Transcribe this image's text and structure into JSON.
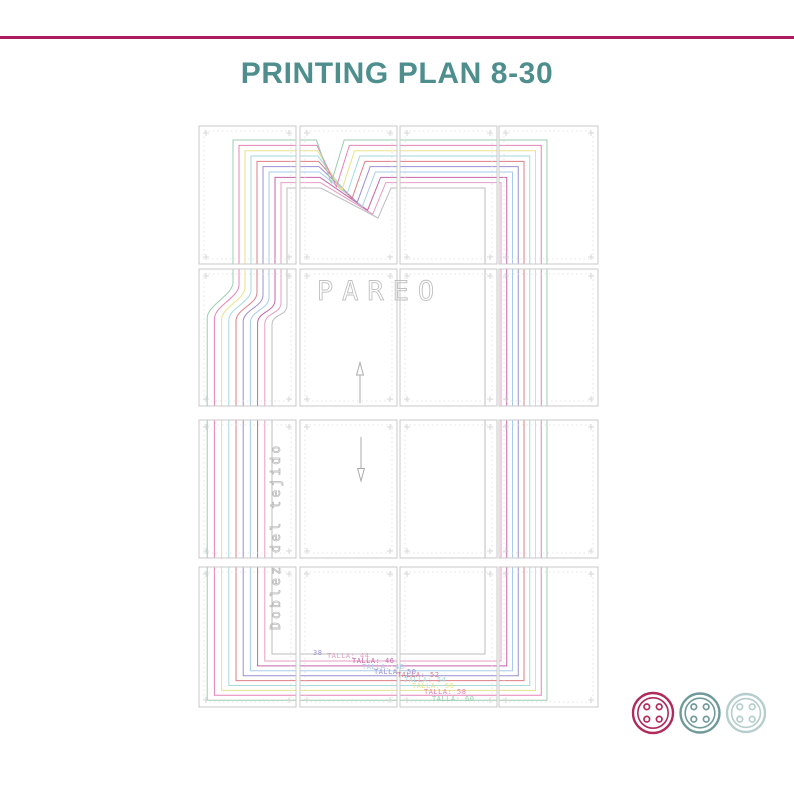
{
  "page": {
    "width": 794,
    "height": 794,
    "background": "#ffffff"
  },
  "header": {
    "title": "PRINTING PLAN 8-30",
    "title_color": "#4e8f8e",
    "rule_color": "#ad1a60"
  },
  "plan": {
    "border_color": "#c9c9c9",
    "margin_dash_color": "#dedede",
    "mark_color": "#cfcfcf",
    "cols": [
      {
        "x": 199,
        "w": 97
      },
      {
        "x": 300,
        "w": 97
      },
      {
        "x": 400,
        "w": 97
      },
      {
        "x": 499,
        "w": 99
      }
    ],
    "rows": [
      {
        "y": 126,
        "h": 138
      },
      {
        "y": 269,
        "h": 137
      },
      {
        "y": 420,
        "h": 138
      },
      {
        "y": 567,
        "h": 140
      }
    ],
    "pareo_label": {
      "text": "PAREO",
      "x": 380,
      "y": 300,
      "size": 27,
      "spacing": 9,
      "color": "#c0c0c0"
    },
    "fold_label": {
      "text": "Doblez del tejido",
      "x": 280,
      "y": 630,
      "size": 13,
      "spacing": 3.2,
      "color": "#b6b6b6"
    },
    "arrow_color": "#ababab",
    "arrows": [
      {
        "dir": "up",
        "x": 360,
        "tail_y": 403,
        "head_base_y": 375,
        "tip_y": 362.5,
        "half_w": 3.4
      },
      {
        "dir": "down",
        "x": 361,
        "tail_y": 437,
        "head_base_y": 468.5,
        "tip_y": 481,
        "half_w": 3.4
      }
    ],
    "sizes": [
      {
        "label": "38",
        "color": "#bdbdbd"
      },
      {
        "label": "TALLA: 44",
        "color": "#e59ec2"
      },
      {
        "label": "TALLA: 46",
        "color": "#c863a8"
      },
      {
        "label": "TALLA: 48",
        "color": "#aacbe8"
      },
      {
        "label": "TALLA: 50",
        "color": "#9c8fd2"
      },
      {
        "label": "TALLA: 52",
        "color": "#de7d85"
      },
      {
        "label": "TALLA: 54",
        "color": "#a5d9de"
      },
      {
        "label": "TALLA: 56",
        "color": "#e8e28b"
      },
      {
        "label": "TALLA: 58",
        "color": "#e583b5"
      },
      {
        "label": "TALLA: 60",
        "color": "#9acdb0"
      }
    ],
    "geometry": {
      "y_top": {
        "base": 188,
        "step": -5.33
      },
      "x_upper_left": {
        "base": 287,
        "step": -6.0
      },
      "x_lower_left": {
        "base": 272,
        "step": -7.2
      },
      "y_curve_start": {
        "base": 305,
        "step": -2.5
      },
      "y_curve_end": {
        "base": 325,
        "step": -0.8
      },
      "x_right": {
        "base": 501,
        "step": 5.75,
        "inner": 485
      },
      "y_bottom": {
        "base": 661,
        "step": 4.9,
        "inner": 654
      },
      "dart": {
        "apex_x_base": 378,
        "apex_x_step": -5.2,
        "apex_y_base": 218,
        "apex_y_step": -3.9,
        "start_x_base": 321,
        "start_x_step": -0.5,
        "end_offset": 13
      }
    },
    "size_labels": [
      {
        "text": "38",
        "x": 313,
        "y": 655,
        "color": "#9c8fd2"
      },
      {
        "text": "TALLA: 44",
        "x": 327,
        "y": 658,
        "color": "#e59ec2"
      },
      {
        "text": "TALLA: 46",
        "x": 352,
        "y": 663,
        "color": "#c863a8"
      },
      {
        "text": "TALLA: 48",
        "x": 362,
        "y": 669,
        "color": "#aacbe8"
      },
      {
        "text": "TALLA: 50",
        "x": 374,
        "y": 674,
        "color": "#9c8fd2"
      },
      {
        "text": "TALLA: 52",
        "x": 397,
        "y": 677,
        "color": "#de7d85"
      },
      {
        "text": "TALLA: 54",
        "x": 404,
        "y": 682,
        "color": "#a5d9de"
      },
      {
        "text": "TALLA: 56",
        "x": 412,
        "y": 688,
        "color": "#e8e28b"
      },
      {
        "text": "TALLA: 58",
        "x": 424,
        "y": 694,
        "color": "#e583b5"
      },
      {
        "text": "TALLA: 60",
        "x": 432,
        "y": 701,
        "color": "#9acdb0"
      }
    ]
  },
  "footer_buttons": [
    {
      "name": "button-crimson",
      "color": "#b02a5b",
      "cx": 653,
      "cy": 713,
      "r": 20
    },
    {
      "name": "button-teal",
      "color": "#6f999b",
      "cx": 700,
      "cy": 713,
      "r": 19.5
    },
    {
      "name": "button-pale-teal",
      "color": "#b5cecd",
      "cx": 746,
      "cy": 713,
      "r": 19
    }
  ]
}
